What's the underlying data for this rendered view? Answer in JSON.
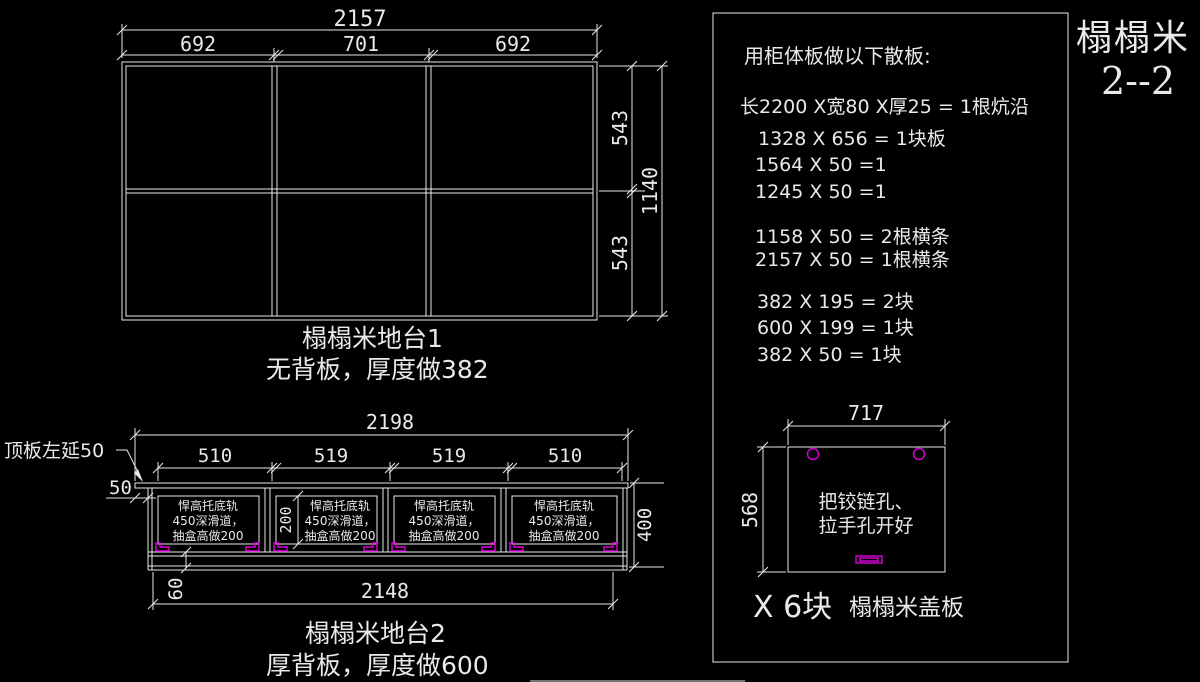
{
  "title": {
    "line1": "榻榻米",
    "line2": "2--2"
  },
  "colors": {
    "background": "#000000",
    "line": "#e9e9e9",
    "text": "#e9e9e9",
    "accent_magenta": "#dd00dd"
  },
  "platform1": {
    "width_total": "2157",
    "widths": [
      "692",
      "701",
      "692"
    ],
    "heights": [
      "543",
      "543"
    ],
    "height_total": "1140",
    "caption_line1": "榻榻米地台1",
    "caption_line2": "无背板，厚度做382"
  },
  "platform2": {
    "top_width": "2198",
    "sections": [
      "510",
      "519",
      "519",
      "510"
    ],
    "leader_note": "顶板左延50",
    "overhang": "50",
    "drawer_height": "200",
    "height": "400",
    "base_height": "60",
    "bottom_width": "2148",
    "drawer_note": {
      "l1": "悍高托底轨",
      "l2": "450深滑道，",
      "l3": "抽盒高做200"
    },
    "caption_line1": "榻榻米地台2",
    "caption_line2": "厚背板，厚度做600"
  },
  "panel": {
    "heading": "用柜体板做以下散板:",
    "lines": [
      "长2200 X宽80 X厚25 = 1根炕沿",
      "1328 X 656 = 1块板",
      "1564 X 50 =1",
      "1245 X 50 =1",
      "1158 X 50 = 2根横条",
      "2157 X 50 = 1根横条",
      "382 X 195 = 2块",
      "600 X 199 = 1块",
      "382 X 50 = 1块"
    ],
    "cover": {
      "width": "717",
      "height": "568",
      "note_line1": "把铰链孔、",
      "note_line2": "拉手孔开好",
      "count_label": "X 6块",
      "name_label": "榻榻米盖板"
    }
  }
}
